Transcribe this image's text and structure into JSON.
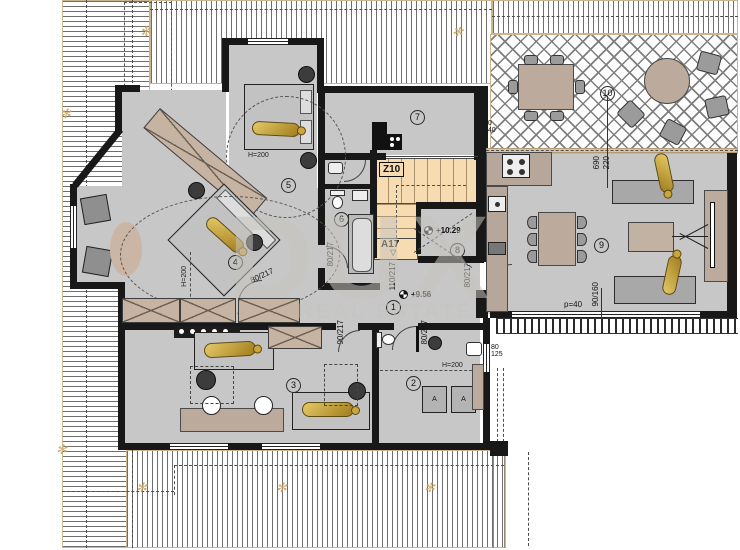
{
  "watermark": {
    "brand": "DUX",
    "tagline": "REAL ESTATE"
  },
  "rooms": {
    "n1": "1",
    "n2": "2",
    "n3": "3",
    "n4": "4",
    "n5": "5",
    "n6": "6",
    "n7": "7",
    "n8": "8",
    "n9": "9",
    "n10": "10"
  },
  "stairs": {
    "upper": "Z10",
    "lower": "A17",
    "direction_glyph": "▽"
  },
  "levels": {
    "hall": "+9.56",
    "upper": "+10.29"
  },
  "doors": {
    "stair": "110/217",
    "bath": "80/217",
    "living": "80/217",
    "laundry": "80/217",
    "bedroom": "80/217",
    "kids": "90/217"
  },
  "windows": {
    "kitchen_w": "60",
    "kitchen_h": "140",
    "laundry_w": "80",
    "laundry_h": "125",
    "living": "90/160",
    "parapet": "p=40",
    "dim_a": "690",
    "dim_b": "220"
  },
  "heights": {
    "r5": "H=200",
    "r4": "H=200",
    "r2": "H=200"
  },
  "appliances": {
    "a1": "A",
    "a2": "A"
  },
  "roof_marks": {
    "m1": "✻",
    "m2": "✻",
    "m3": "✻",
    "m4": "✻",
    "m5": "✻",
    "m6": "✻",
    "m7": "✻",
    "m8": "✻"
  },
  "colors": {
    "floor": "#c7c7c7",
    "wall": "#181818",
    "stair": "#f7dcb2",
    "beige": "#bcab9c",
    "gold": "#c9a33f",
    "watermark": "#c6c3be"
  }
}
